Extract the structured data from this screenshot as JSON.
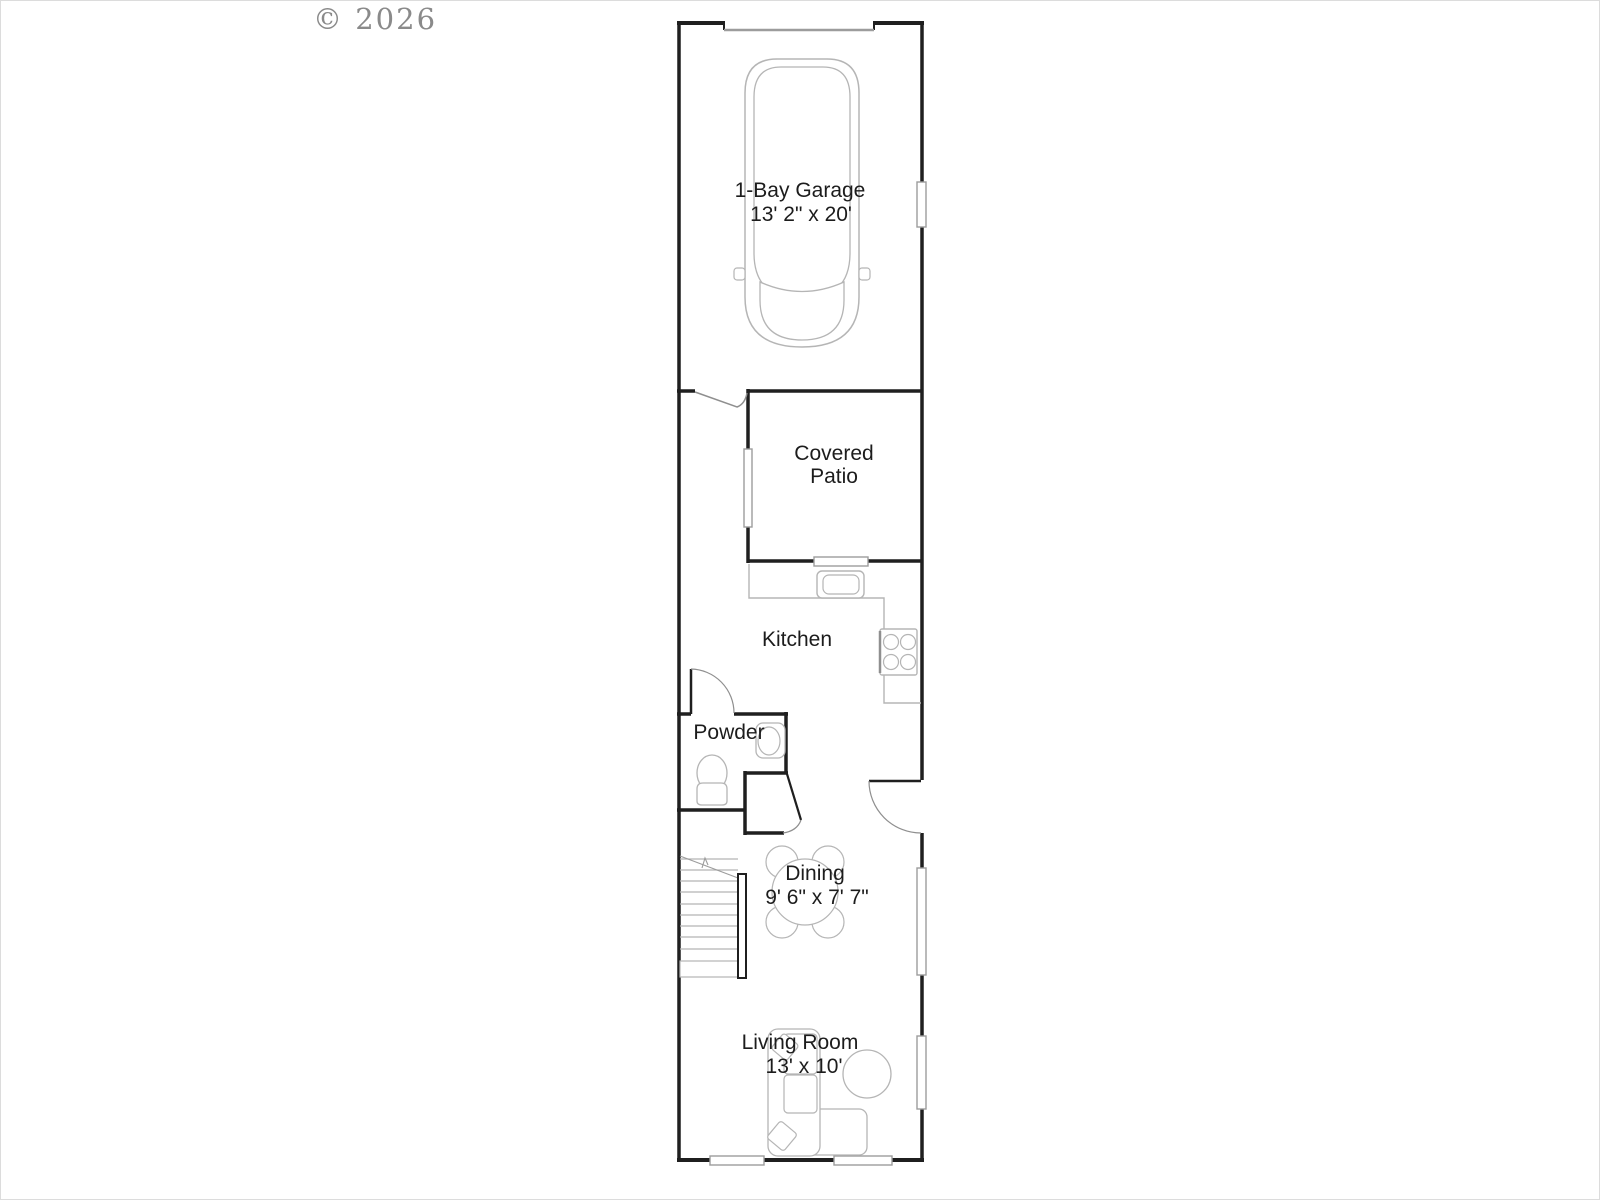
{
  "watermark": "© 2026",
  "plan": {
    "rooms": {
      "garage": {
        "label": "1-Bay Garage",
        "dims": "13' 2\" x 20'"
      },
      "patio": {
        "label_line1": "Covered",
        "label_line2": "Patio"
      },
      "kitchen": {
        "label": "Kitchen"
      },
      "powder": {
        "label": "Powder"
      },
      "dining": {
        "label": "Dining",
        "dims": "9' 6\" x 7' 7\""
      },
      "living": {
        "label": "Living Room",
        "dims": "13' x 10'"
      }
    },
    "colors": {
      "wall": "#1f1f1f",
      "fixture": "#b5b5b5",
      "text": "#1c1c1c",
      "watermark": "#8a8a8a",
      "background": "#ffffff"
    }
  }
}
